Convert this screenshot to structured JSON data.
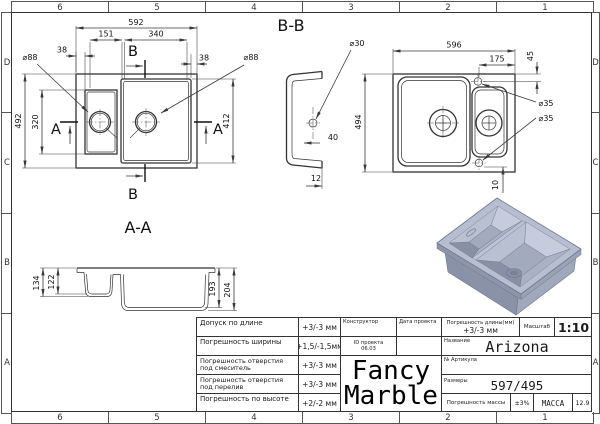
{
  "sheet": {
    "zones_top": [
      "6",
      "5",
      "4",
      "3",
      "2",
      "1"
    ],
    "zones_bottom": [
      "6",
      "5",
      "4",
      "3",
      "2",
      "1"
    ],
    "zones_side": [
      "D",
      "C",
      "B",
      "A"
    ]
  },
  "views": {
    "top": {
      "d592": "592",
      "d151": "151",
      "d340": "340",
      "d38_left": "38",
      "d38_right": "38",
      "d492": "492",
      "d320": "320",
      "d412": "412",
      "d88_left": "⌀88",
      "d88_right": "⌀88",
      "mark_a": "A",
      "mark_b": "B"
    },
    "bb": {
      "title": "B-B",
      "d30": "⌀30",
      "d40": "40",
      "d12": "12",
      "d596": "596",
      "d175": "175",
      "d45": "45",
      "d494": "494",
      "d35": "⌀35",
      "d10": "10"
    },
    "aa": {
      "title": "A-A",
      "d134": "134",
      "d122": "122",
      "d193": "193",
      "d204": "204"
    }
  },
  "title_block": {
    "tolerances": [
      {
        "label": "Допуск по длине",
        "value": "+3/-3 мм"
      },
      {
        "label": "Погрешность ширины",
        "value": "+1,5/-1,5мм"
      },
      {
        "label": "Погрешность отверстия под смеситель",
        "value": "+3/-3 мм"
      },
      {
        "label": "Погрешность отверстия под перелив",
        "value": "+3/-3 мм"
      },
      {
        "label": "Погрешность по высоте",
        "value": "+2/-2 мм"
      }
    ],
    "constructor_label": "Конструктор",
    "project_date_label": "Дата проекта",
    "project_id_line1": "ID проекта",
    "project_id_line2": "06.03",
    "logo_line1": "Fancy",
    "logo_line2": "Marble",
    "length_tolerance_label": "Погрешность длины(мм)",
    "length_tolerance_value": "+3/-3 мм",
    "scale_label": "Масштаб",
    "scale_value": "1:10",
    "name_label": "Название",
    "product_name": "Arizona",
    "article_label": "№ Артикула",
    "dimensions_label": "Размеры",
    "dimensions_value": "597/495",
    "mass_tolerance_label": "Погрешность массы",
    "mass_tolerance_value": "±3%",
    "mass_label": "МАССА",
    "mass_value": "12.9"
  },
  "render_colors": {
    "rim_top": "#b7becf",
    "rim_edge_right": "#9aa2b6",
    "rim_edge_left": "#8d95aa",
    "body_left": "#8a92a7",
    "body_right": "#a0a8bc",
    "bowl_wall_light": "#c6ccdb",
    "bowl_wall_mid": "#aab1c4",
    "bowl_wall_side": "#b9c0d0",
    "bowl_wall_dark": "#8890a5",
    "bowl_bottom": "#a2aabd",
    "divider": "#bcc3d4",
    "drain": "#798196",
    "outline": "#6d7690"
  }
}
